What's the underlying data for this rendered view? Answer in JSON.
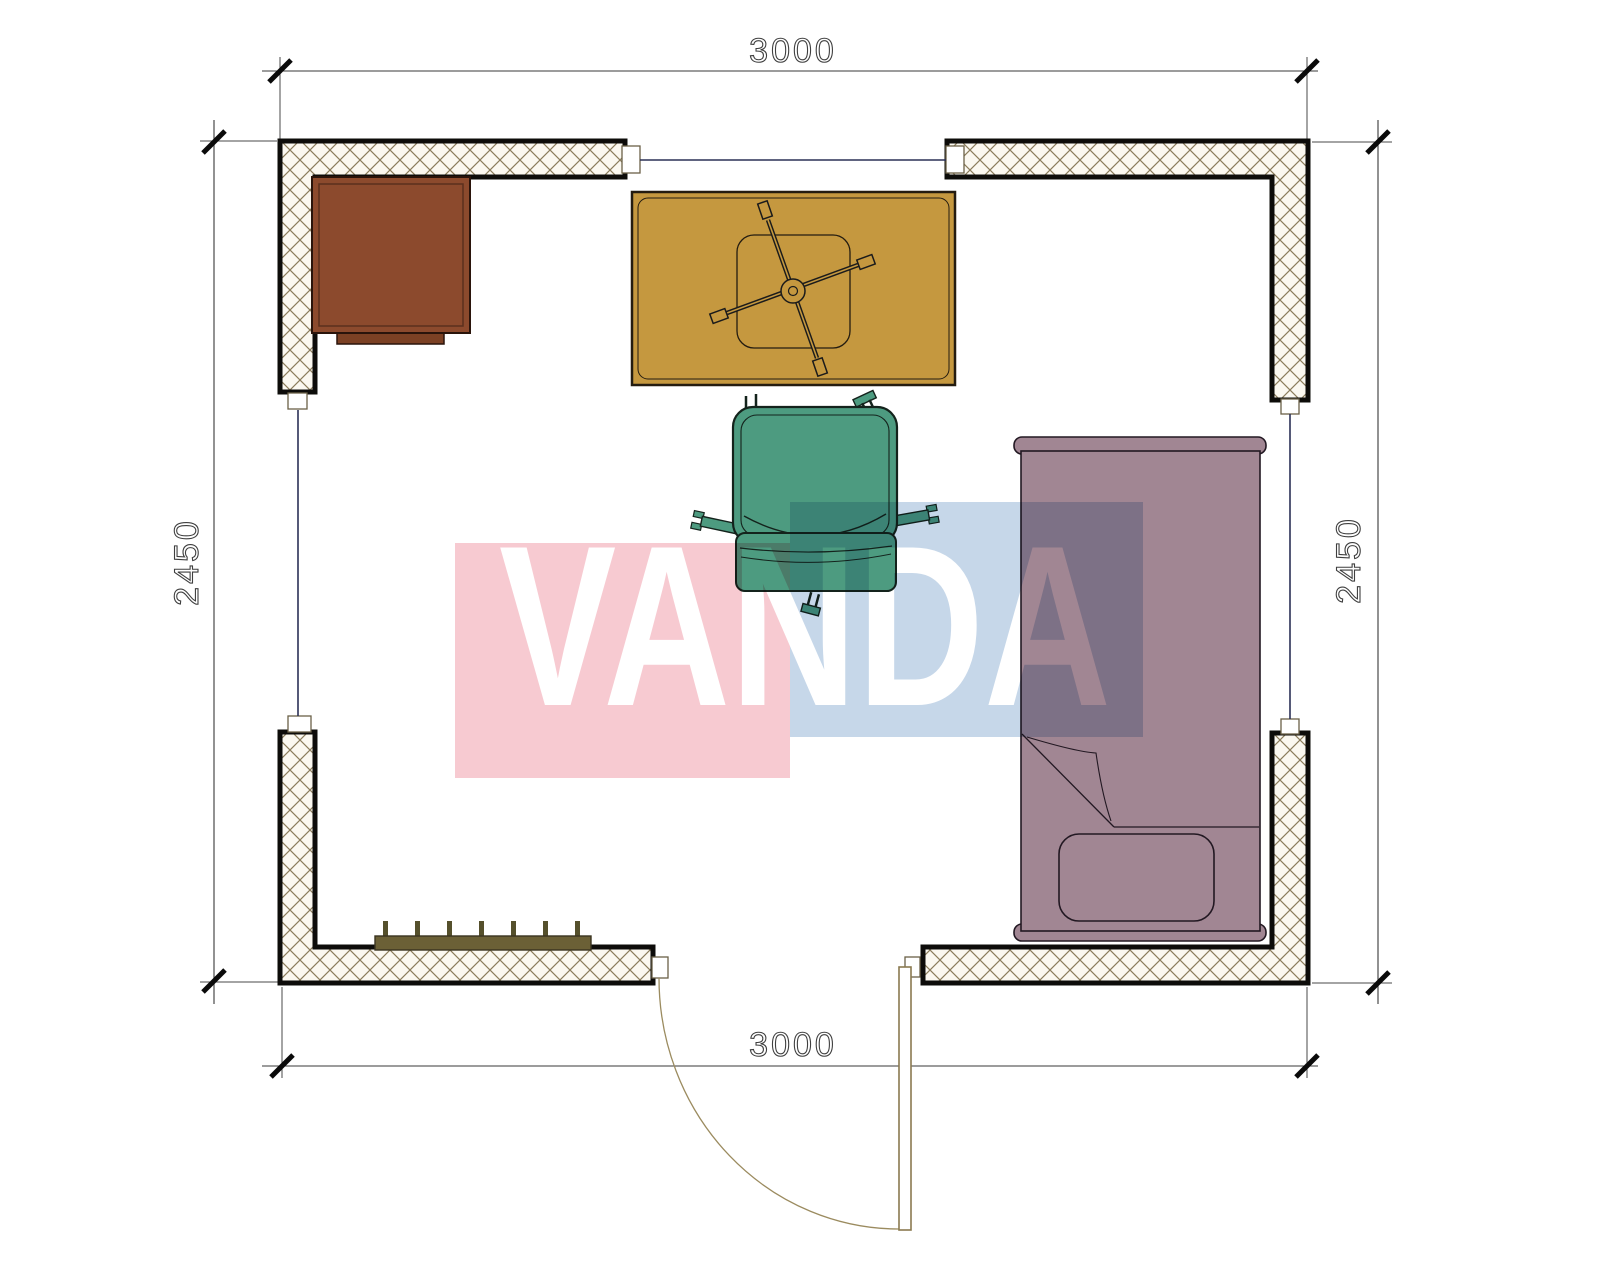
{
  "drawing": {
    "type": "floor-plan",
    "room": "single room with desk, table, office chair, bed, radiator and door"
  },
  "dimensions": {
    "top": "3000",
    "bottom": "3000",
    "left": "2450",
    "right": "2450"
  },
  "watermark": {
    "text": "VANDA",
    "pink_color": "#f7cad1",
    "blue_color": "#c6d7e9"
  },
  "colors": {
    "wall_fill": "#fbf8f0",
    "wall_hatch": "#8b7d5c",
    "wall_border": "#0d0c0a",
    "window_line": "#2b3057",
    "door": "#8a7a50",
    "door_arc": "#9b8b5f",
    "desk": "#8c4a2d",
    "desk_step": "#7c4124",
    "table": "#c5983f",
    "chair": "#4d9b80",
    "bed": "#a18693",
    "radiator": "#6b6036",
    "radiator_tick": "#55502c",
    "dim_line": "#3a3a3a",
    "tick": "#0a0a0a"
  }
}
